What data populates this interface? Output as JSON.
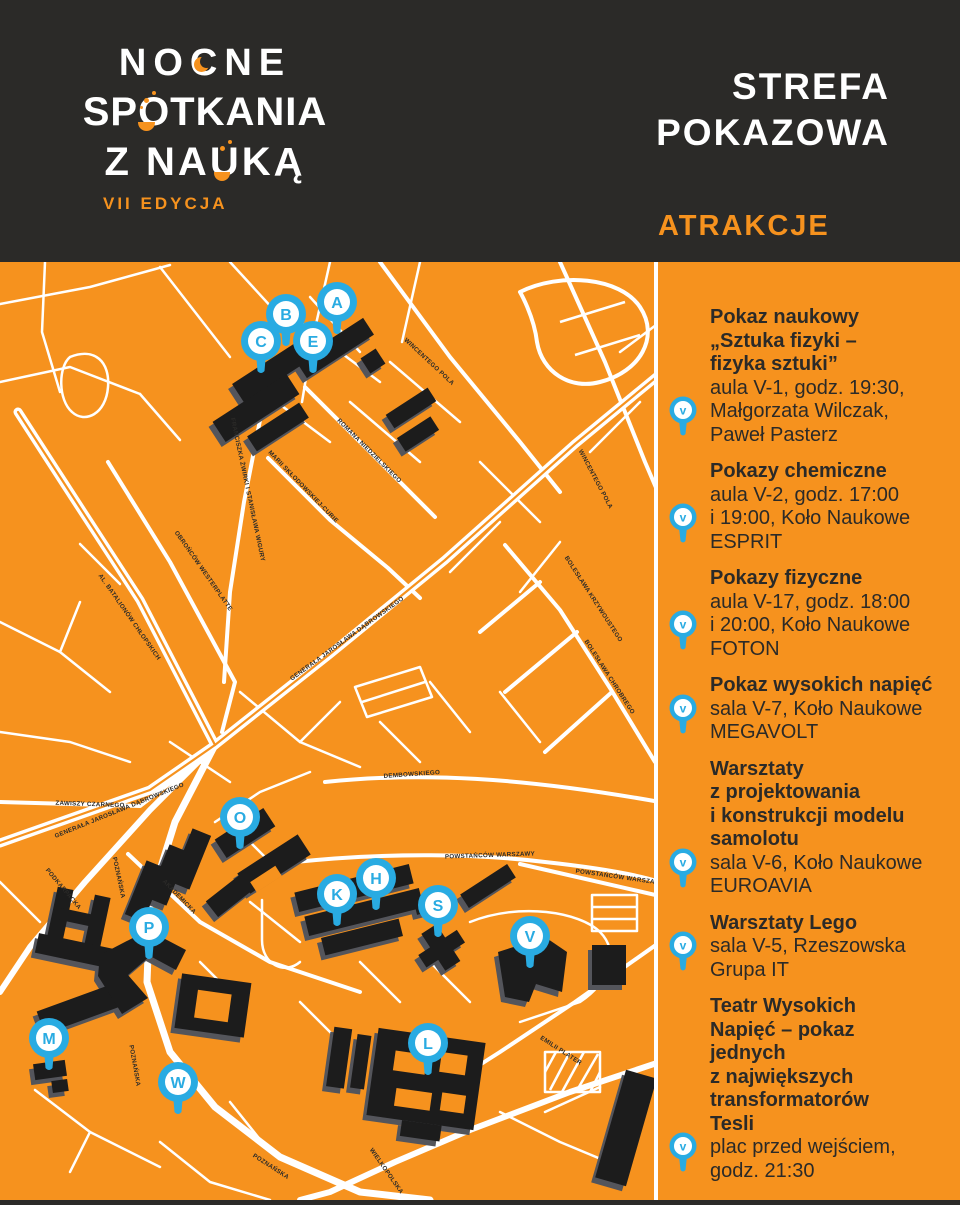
{
  "colors": {
    "orange": "#F6921E",
    "dark": "#2B2A28",
    "blue": "#29ABE2",
    "white": "#FFFFFF",
    "building": "#1C1C1C",
    "building_side": "#54555B"
  },
  "header": {
    "logo_line1": "NOCNE",
    "logo_line2": "SPOTKANIA",
    "logo_line3": "Z NAUKĄ",
    "edition": "VII EDYCJA",
    "zone_title_line1": "STREFA",
    "zone_title_line2": "POKAZOWA",
    "attractions_label": "ATRAKCJE"
  },
  "map": {
    "markers": [
      {
        "letter": "A",
        "x": 337,
        "y": 302
      },
      {
        "letter": "B",
        "x": 286,
        "y": 314
      },
      {
        "letter": "C",
        "x": 261,
        "y": 341
      },
      {
        "letter": "E",
        "x": 313,
        "y": 341
      },
      {
        "letter": "O",
        "x": 240,
        "y": 817
      },
      {
        "letter": "P",
        "x": 149,
        "y": 927
      },
      {
        "letter": "K",
        "x": 337,
        "y": 894
      },
      {
        "letter": "H",
        "x": 376,
        "y": 878
      },
      {
        "letter": "S",
        "x": 438,
        "y": 905
      },
      {
        "letter": "V",
        "x": 530,
        "y": 936
      },
      {
        "letter": "M",
        "x": 49,
        "y": 1038
      },
      {
        "letter": "W",
        "x": 178,
        "y": 1082
      },
      {
        "letter": "L",
        "x": 428,
        "y": 1043
      }
    ],
    "street_labels": [
      {
        "text": "WINCENTEGO POLA",
        "x": 428,
        "y": 363,
        "rot": 43
      },
      {
        "text": "WINCENTEGO POLA",
        "x": 594,
        "y": 480,
        "rot": 62
      },
      {
        "text": "ROMANA NIEDZIELSKIEGO",
        "x": 368,
        "y": 452,
        "rot": 45
      },
      {
        "text": "MARII SKŁODOWSKIEJ-CURIE",
        "x": 302,
        "y": 488,
        "rot": 46
      },
      {
        "text": "FRANCISZKA ŻWIRKI I STANISŁAWA WIGURY",
        "x": 246,
        "y": 490,
        "rot": 78
      },
      {
        "text": "GENERAŁA JAROSŁAWA DĄBROWSKIEGO",
        "x": 348,
        "y": 640,
        "rot": -36
      },
      {
        "text": "GENERAŁA JAROSŁAWA DĄBROWSKIEGO",
        "x": 120,
        "y": 812,
        "rot": -22
      },
      {
        "text": "OBROŃCÓW WESTERPLATTE",
        "x": 202,
        "y": 572,
        "rot": 55
      },
      {
        "text": "AL. BATALIONÓW CHŁOPSKICH",
        "x": 128,
        "y": 618,
        "rot": 55
      },
      {
        "text": "ZAWISZY CZARNEGO",
        "x": 90,
        "y": 806,
        "rot": 2
      },
      {
        "text": "PODKARPACKA",
        "x": 62,
        "y": 890,
        "rot": 50
      },
      {
        "text": "POZNAŃSKA",
        "x": 117,
        "y": 878,
        "rot": 78
      },
      {
        "text": "POZNAŃSKA",
        "x": 133,
        "y": 1066,
        "rot": 80
      },
      {
        "text": "POZNAŃSKA",
        "x": 270,
        "y": 1168,
        "rot": 33
      },
      {
        "text": "AKADEMICKA",
        "x": 178,
        "y": 898,
        "rot": 46
      },
      {
        "text": "DEMBOWSKIEGO",
        "x": 412,
        "y": 776,
        "rot": -4
      },
      {
        "text": "POWSTAŃCÓW WARSZAWY",
        "x": 490,
        "y": 857,
        "rot": -2
      },
      {
        "text": "POWSTAŃCÓW WARSZAWY",
        "x": 620,
        "y": 879,
        "rot": 8
      },
      {
        "text": "EMILII PLATER",
        "x": 560,
        "y": 1052,
        "rot": 33
      },
      {
        "text": "BOLESŁAWA KRZYWOUSTEGO",
        "x": 592,
        "y": 600,
        "rot": 57
      },
      {
        "text": "BOLESŁAWA CHROBREGO",
        "x": 608,
        "y": 678,
        "rot": 57
      },
      {
        "text": "WIELKOPOLSKA",
        "x": 385,
        "y": 1172,
        "rot": 55
      }
    ]
  },
  "sidebar": {
    "items": [
      {
        "title_lines": [
          "Pokaz naukowy",
          "„Sztuka fizyki –",
          "fizyka sztuki”"
        ],
        "detail_lines": [
          "aula V-1, godz. 19:30,",
          "Małgorzata Wilczak,",
          "Paweł Pasterz"
        ],
        "pin": "v",
        "pin_line": 1
      },
      {
        "title_lines": [
          "Pokazy chemiczne"
        ],
        "detail_lines": [
          "aula V-2, godz. 17:00",
          "i 19:00, Koło Naukowe",
          "ESPRIT"
        ],
        "pin": "v",
        "pin_line": 1
      },
      {
        "title_lines": [
          "Pokazy fizyczne"
        ],
        "detail_lines": [
          "aula V-17, godz. 18:00",
          "i 20:00, Koło Naukowe",
          "FOTON"
        ],
        "pin": "v",
        "pin_line": 1
      },
      {
        "title_lines": [
          "Pokaz wysokich napięć"
        ],
        "detail_lines": [
          "sala V-7, Koło Naukowe",
          "MEGAVOLT"
        ],
        "pin": "v",
        "pin_line": 0
      },
      {
        "title_lines": [
          "Warsztaty",
          "z projektowania",
          "i konstrukcji modelu",
          "samolotu"
        ],
        "detail_lines": [
          "sala V-6, Koło Naukowe",
          "EUROAVIA"
        ],
        "pin": "v",
        "pin_line": 0
      },
      {
        "title_lines": [
          "Warsztaty Lego"
        ],
        "detail_lines": [
          "sala V-5, Rzeszowska",
          "Grupa IT"
        ],
        "pin": "v",
        "pin_line": 0
      },
      {
        "title_lines": [
          "Teatr Wysokich",
          "Napięć – pokaz",
          "jednych",
          "z największych",
          "transformatorów",
          "Tesli"
        ],
        "detail_lines": [
          "plac przed wejściem,",
          "godz. 21:30"
        ],
        "pin": "v",
        "pin_line": 0
      }
    ]
  }
}
